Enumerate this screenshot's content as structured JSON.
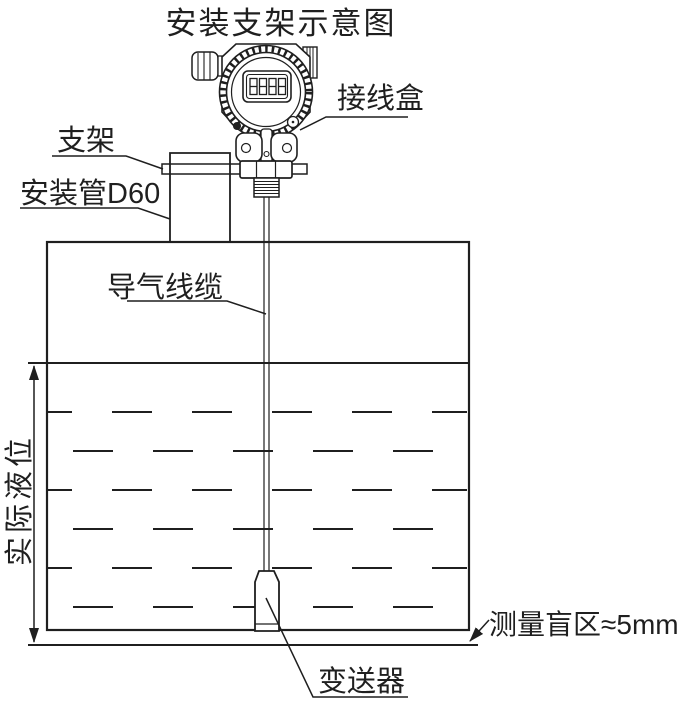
{
  "title": "安装支架示意图",
  "diagram": {
    "labels": {
      "junction_box": "接线盒",
      "bracket": "支架",
      "mounting_pipe": "安装管D60",
      "air_cable": "导气线缆",
      "actual_level": "实际液位",
      "transmitter": "变送器",
      "blind_zone": "测量盲区≈5mm"
    },
    "lcd_value": "8888",
    "colors": {
      "line": "#1f1f1f",
      "background": "#ffffff"
    }
  }
}
